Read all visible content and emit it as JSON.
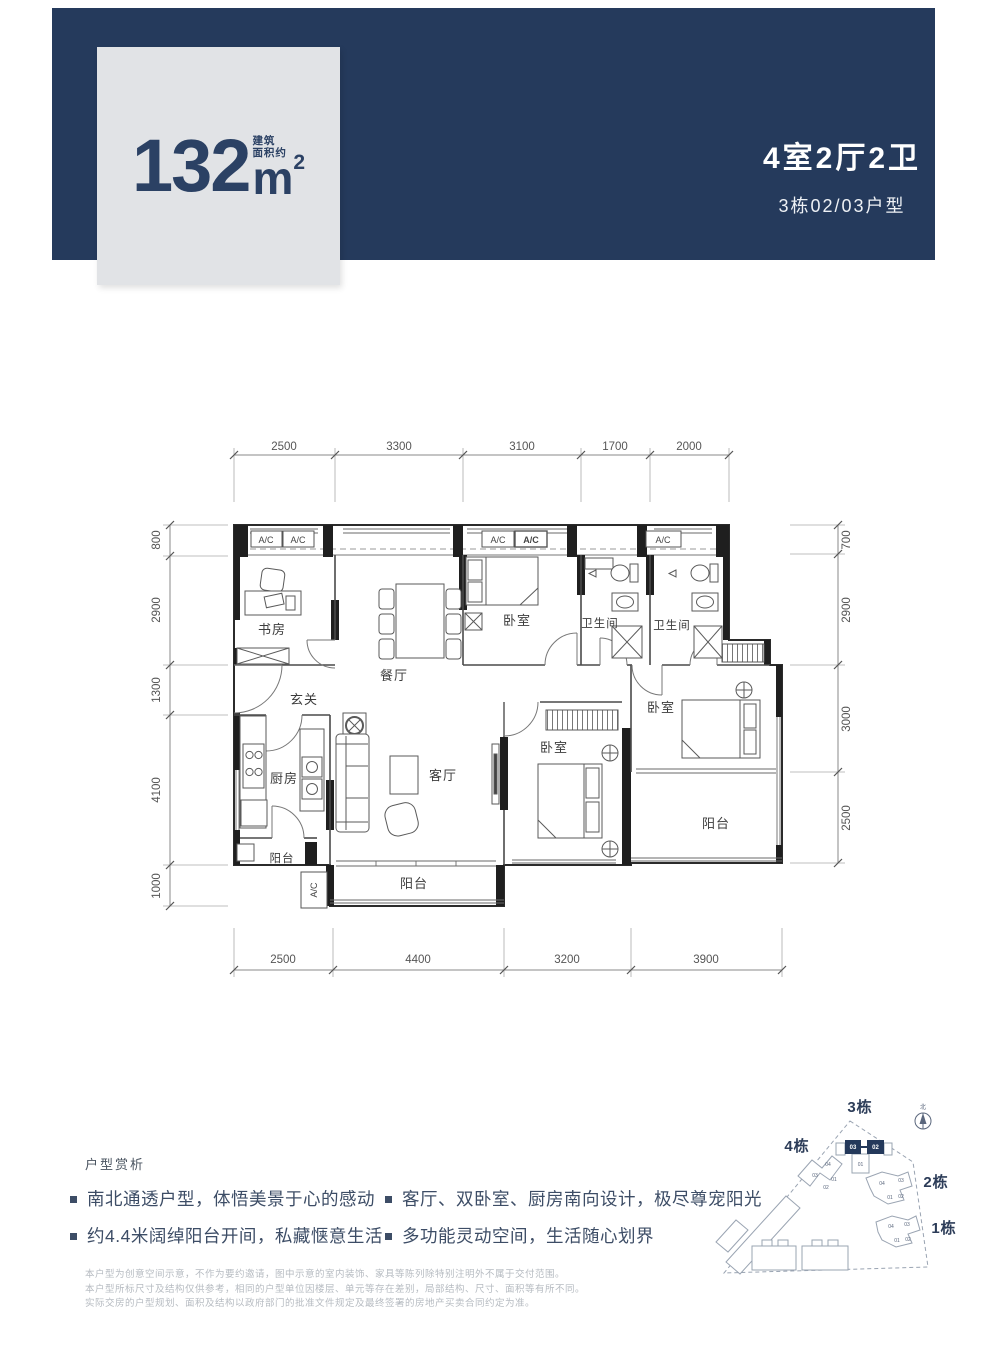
{
  "header": {
    "band_color": "#253a5c",
    "card": {
      "bg": "#e1e3e6",
      "text_color": "#2b4164",
      "area_value": "132",
      "area_unit": "m",
      "area_exp": "2",
      "area_note_line1": "建筑",
      "area_note_line2": "面积约"
    },
    "title": "4室2厅2卫",
    "subtitle": "3栋02/03户型"
  },
  "floor_plan": {
    "rooms": {
      "study": "书房",
      "dining": "餐厅",
      "entry": "玄关",
      "kitchen": "厨房",
      "living": "客厅",
      "balcony_kitchen": "阳台",
      "balcony_south": "阳台",
      "balcony_east": "阳台",
      "bedroom_north": "卧室",
      "bedroom_middle": "卧室",
      "bedroom_east": "卧室",
      "bath_a": "卫生间",
      "bath_b": "卫生间"
    },
    "ac_units": [
      "A/C",
      "A/C",
      "A/C",
      "A/C",
      "A/C",
      "A/C"
    ],
    "dims": {
      "top": [
        "2500",
        "3300",
        "3100",
        "1700",
        "2000"
      ],
      "bottom": [
        "2500",
        "4400",
        "3200",
        "3900"
      ],
      "left": [
        "800",
        "2900",
        "1300",
        "4100",
        "1000"
      ],
      "right": [
        "700",
        "2900",
        "3000",
        "2500"
      ]
    }
  },
  "analysis": {
    "heading": "户型赏析",
    "bullets_left": [
      "南北通透户型，体悟美景于心的感动",
      "约4.4米阔绰阳台开间，私藏惬意生活"
    ],
    "bullets_right": [
      "客厅、双卧室、厨房南向设计，极尽尊宠阳光",
      "多功能灵动空间，生活随心划界"
    ]
  },
  "disclaimer": [
    "本户型为创意空间示意，不作为要约邀请，图中示意的室内装饰、家具等陈列除特别注明外不属于交付范围。",
    "本户型所标尺寸及结构仅供参考，相同的户型单位因楼层、单元等存在差别，局部结构、尺寸、面积等有所不同。",
    "实际交房的户型规划、面积及结构以政府部门的批准文件规定及最终签署的房地产买卖合同约定为准。"
  ],
  "site_plan": {
    "highlight_color": "#24395b",
    "north": "北",
    "buildings": [
      "3栋",
      "4栋",
      "2栋",
      "1栋"
    ],
    "units_highlight": [
      "03",
      "02"
    ],
    "units_b3": [
      "01"
    ],
    "units_b4": [
      "04",
      "03",
      "01",
      "02"
    ],
    "units_b2": [
      "04",
      "03",
      "01",
      "02"
    ],
    "units_b1": [
      "04",
      "03",
      "01",
      "02"
    ]
  }
}
